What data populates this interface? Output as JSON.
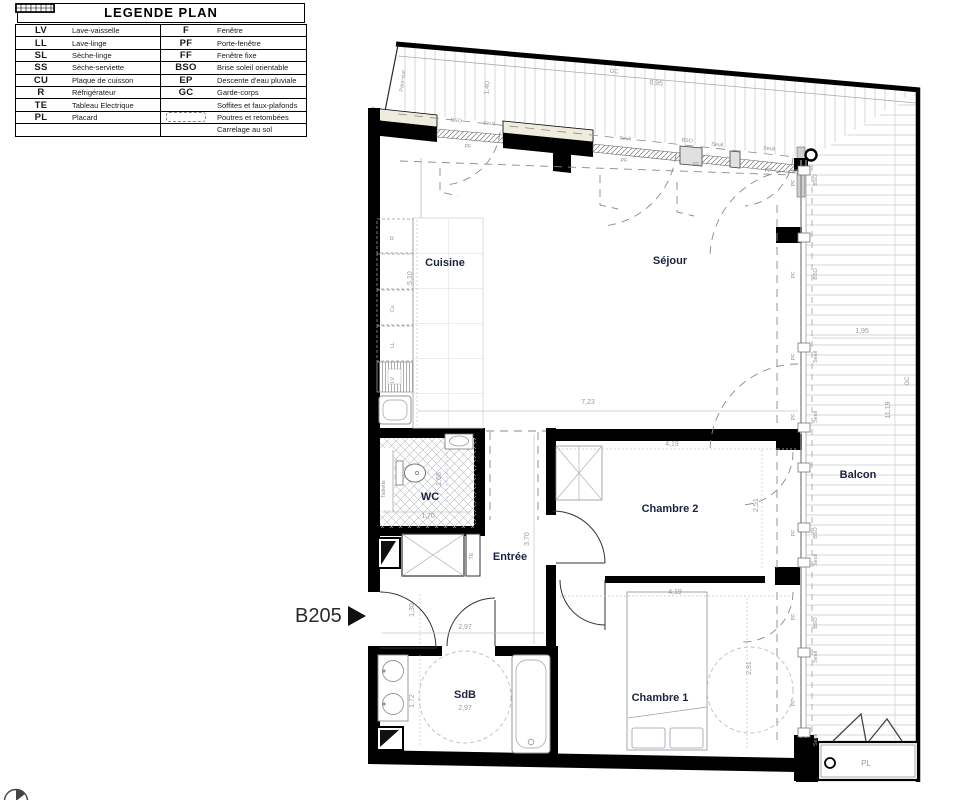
{
  "legend": {
    "title": "LEGENDE PLAN",
    "left": [
      {
        "abbr": "LV",
        "label": "Lave-vaisselle"
      },
      {
        "abbr": "LL",
        "label": "Lave-linge"
      },
      {
        "abbr": "SL",
        "label": "Sèche-linge"
      },
      {
        "abbr": "SS",
        "label": "Sèche-serviette"
      },
      {
        "abbr": "CU",
        "label": "Plaque de cuisson"
      },
      {
        "abbr": "R",
        "label": "Réfrigérateur"
      },
      {
        "abbr": "TE",
        "label": "Tableau Electrique"
      },
      {
        "abbr": "PL",
        "label": "Placard"
      },
      {
        "abbr": "",
        "label": ""
      }
    ],
    "right": [
      {
        "abbr": "F",
        "label": "Fenêtre"
      },
      {
        "abbr": "PF",
        "label": "Porte-fenêtre"
      },
      {
        "abbr": "FF",
        "label": "Fenêtre fixe"
      },
      {
        "abbr": "BSO",
        "label": "Brise soleil orientable"
      },
      {
        "abbr": "EP",
        "label": "Descente d'eau pluviale"
      },
      {
        "abbr": "GC",
        "label": "Garde-corps"
      },
      {
        "symbol": "soffites-hatch",
        "label": "Soffites et faux-plafonds"
      },
      {
        "symbol": "dashed-outline",
        "label": "Poutres et retombées"
      },
      {
        "symbol": "tile-grid",
        "label": "Carrelage au sol"
      }
    ]
  },
  "unit": {
    "label": "B205"
  },
  "rooms": {
    "cuisine": "Cuisine",
    "sejour": "Séjour",
    "wc": "WC",
    "entree": "Entrée",
    "chambre2": "Chambre 2",
    "chambre1": "Chambre 1",
    "sdb": "SdB",
    "balcon": "Balcon",
    "placard": "PL"
  },
  "dims": {
    "top_width": "8,95",
    "top_depth": "1,40",
    "kitchen_h": "5,10",
    "sejour_w": "7,23",
    "balcony_w": "1,95",
    "balcony_h": "11,19",
    "ch2_w": "4,19",
    "ch2_h": "2,51",
    "wc_h": "1,66",
    "wc_w": "1,70",
    "entree_h": "3,70",
    "entry_w": "1,30",
    "hall_w": "2,97",
    "sdb_w": "2,97",
    "sdb_h": "1,72",
    "ch1_w": "4,19",
    "ch1_h": "2,91"
  },
  "labels": {
    "pf": "PF",
    "bso": "BSO",
    "seuil": "Seuil",
    "gc": "GC",
    "pare_vue": "Pare-vue",
    "tablette": "Tablette",
    "te": "TE",
    "r": "R",
    "cu": "Cu",
    "ll": "LL",
    "lv": "LV"
  },
  "colors": {
    "wall": "#000000",
    "room_label": "#1c2340",
    "dim_label": "#9b9ba1",
    "annotation": "#8f939b",
    "hatch_line": "#c9cdd2"
  }
}
